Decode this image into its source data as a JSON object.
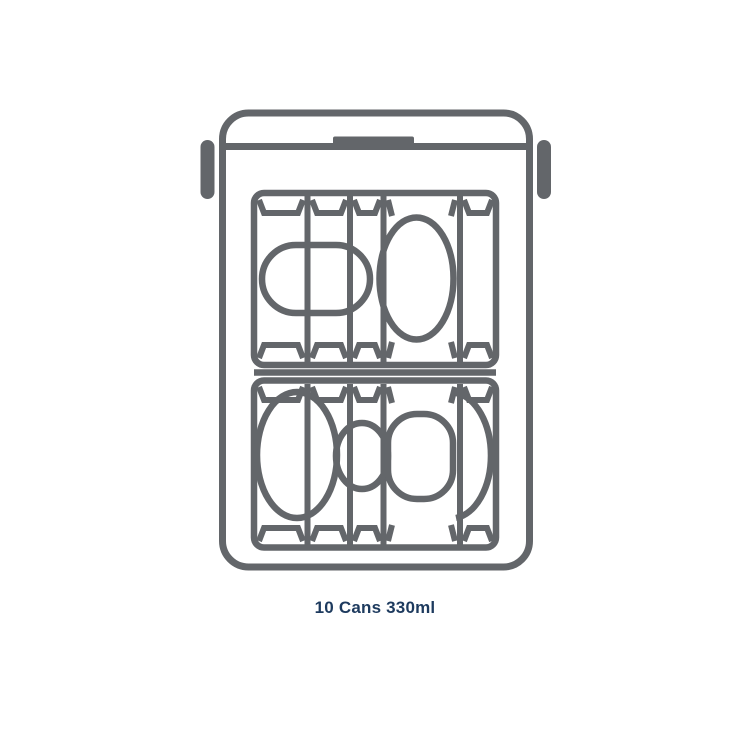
{
  "page": {
    "background": "#ffffff"
  },
  "colors": {
    "line": "#63666a",
    "caption": "#1d3a5e"
  },
  "illustration": {
    "name": "cooler-box-top-view-with-cans",
    "description": "Outline drawing of a cool box seen from above: lid line with centre latch, a grab handle on each side, interior packed with two rows of drink cans shown as columns with oval can faces"
  },
  "caption": {
    "text": "10 Cans 330ml"
  }
}
